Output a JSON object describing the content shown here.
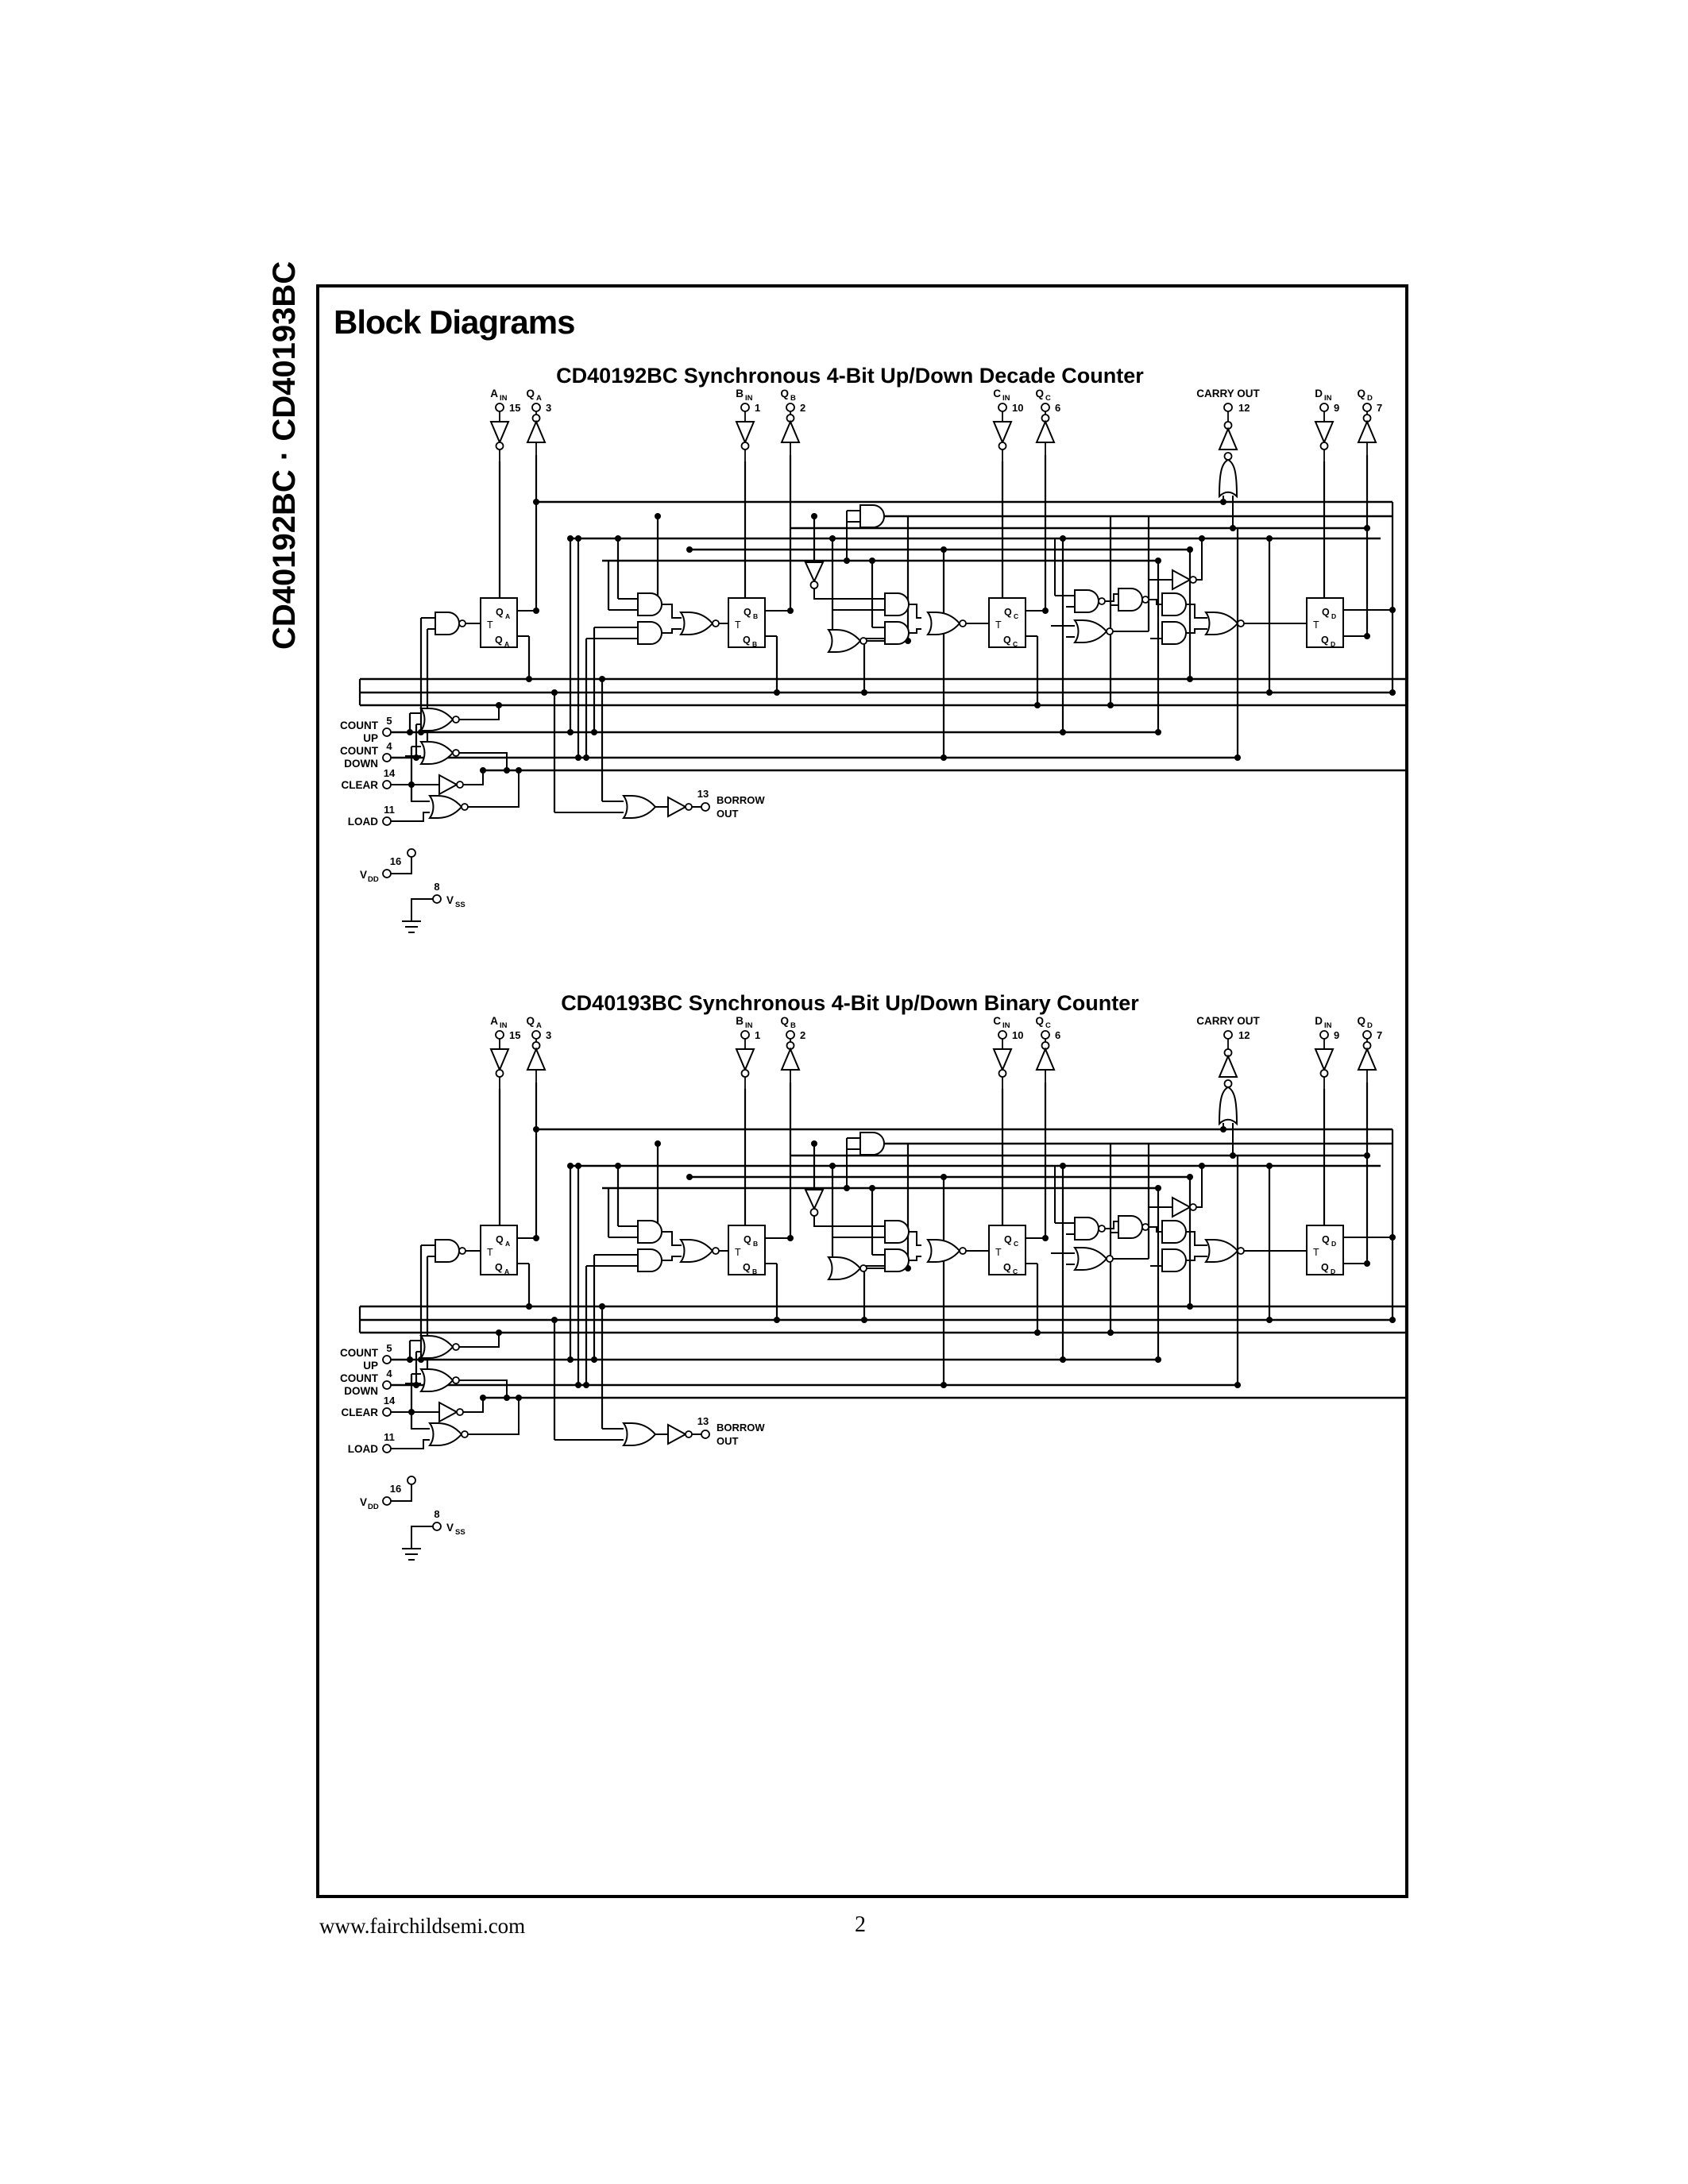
{
  "page": {
    "sidebar_title": "CD40192BC · CD40193BC",
    "section_title": "Block Diagrams",
    "footer_url": "www.fairchildsemi.com",
    "footer_page": "2"
  },
  "diagram1": {
    "title": "CD40192BC Synchronous 4-Bit Up/Down Decade Counter",
    "pins": {
      "ain": {
        "name": "A",
        "sub": "IN",
        "num": "15"
      },
      "qa": {
        "name": "Q",
        "sub": "A",
        "num": "3"
      },
      "bin": {
        "name": "B",
        "sub": "IN",
        "num": "1"
      },
      "qb": {
        "name": "Q",
        "sub": "B",
        "num": "2"
      },
      "cin": {
        "name": "C",
        "sub": "IN",
        "num": "10"
      },
      "qc": {
        "name": "Q",
        "sub": "C",
        "num": "6"
      },
      "carry": {
        "label": "CARRY OUT",
        "num": "12"
      },
      "din": {
        "name": "D",
        "sub": "IN",
        "num": "9"
      },
      "qd": {
        "name": "Q",
        "sub": "D",
        "num": "7"
      }
    },
    "inputs": {
      "count_up": {
        "l1": "COUNT",
        "l2": "UP",
        "num": "5"
      },
      "count_down": {
        "l1": "COUNT",
        "l2": "DOWN",
        "num": "4"
      },
      "clear": {
        "label": "CLEAR",
        "num": "14"
      },
      "load": {
        "label": "LOAD",
        "num": "11"
      }
    },
    "borrow": {
      "l1": "BORROW",
      "l2": "OUT",
      "num": "13"
    },
    "power": {
      "v": "V",
      "dd": "DD",
      "dd_num": "16",
      "ss": "SS",
      "ss_num": "8"
    },
    "ff": [
      {
        "t": "T",
        "q": "Q",
        "s": "A"
      },
      {
        "t": "T",
        "q": "Q",
        "s": "B"
      },
      {
        "t": "T",
        "q": "Q",
        "s": "C"
      },
      {
        "t": "T",
        "q": "Q",
        "s": "D"
      }
    ]
  },
  "diagram2": {
    "title": "CD40193BC Synchronous 4-Bit Up/Down Binary Counter",
    "pins": {
      "ain": {
        "name": "A",
        "sub": "IN",
        "num": "15"
      },
      "qa": {
        "name": "Q",
        "sub": "A",
        "num": "3"
      },
      "bin": {
        "name": "B",
        "sub": "IN",
        "num": "1"
      },
      "qb": {
        "name": "Q",
        "sub": "B",
        "num": "2"
      },
      "cin": {
        "name": "C",
        "sub": "IN",
        "num": "10"
      },
      "qc": {
        "name": "Q",
        "sub": "C",
        "num": "6"
      },
      "carry": {
        "label": "CARRY OUT",
        "num": "12"
      },
      "din": {
        "name": "D",
        "sub": "IN",
        "num": "9"
      },
      "qd": {
        "name": "Q",
        "sub": "D",
        "num": "7"
      }
    },
    "inputs": {
      "count_up": {
        "l1": "COUNT",
        "l2": "UP",
        "num": "5"
      },
      "count_down": {
        "l1": "COUNT",
        "l2": "DOWN",
        "num": "4"
      },
      "clear": {
        "label": "CLEAR",
        "num": "14"
      },
      "load": {
        "label": "LOAD",
        "num": "11"
      }
    },
    "borrow": {
      "l1": "BORROW",
      "l2": "OUT",
      "num": "13"
    },
    "power": {
      "v": "V",
      "dd": "DD",
      "dd_num": "16",
      "ss": "SS",
      "ss_num": "8"
    },
    "ff": [
      {
        "t": "T",
        "q": "Q",
        "s": "A"
      },
      {
        "t": "T",
        "q": "Q",
        "s": "B"
      },
      {
        "t": "T",
        "q": "Q",
        "s": "C"
      },
      {
        "t": "T",
        "q": "Q",
        "s": "D"
      }
    ]
  }
}
